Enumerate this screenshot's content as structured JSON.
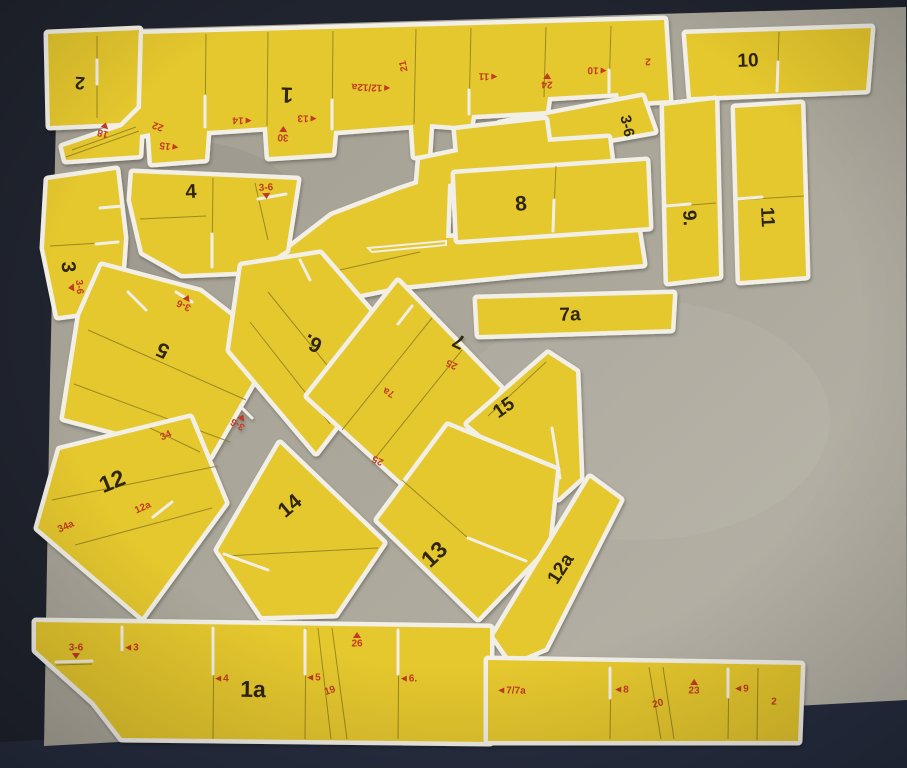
{
  "scene": {
    "description": "Photograph of a paper model kit: yellow cut-out card parts with white borders laid on a grey cardboard sheet on a dark table",
    "surface": "grey cardboard on dark navy table"
  },
  "colors": {
    "table_dark": "#20242e",
    "table_dark_bottom": "#272e40",
    "cardboard": "#a9a59a",
    "cardboard_light": "#b9b5aa",
    "paper_white": "#f2efe6",
    "part_yellow": "#e5c72f",
    "cut_line": "#8a7820",
    "number_black": "#2f2710",
    "mark_red": "#c03a20"
  },
  "parts": {
    "p1": {
      "number": "1"
    },
    "p1a": {
      "number": "1a"
    },
    "p2": {
      "number": "2"
    },
    "p3": {
      "number": "3"
    },
    "p4": {
      "number": "4"
    },
    "p5": {
      "number": "5"
    },
    "p6": {
      "number": "6."
    },
    "p7": {
      "number": "7"
    },
    "p7a": {
      "number": "7a"
    },
    "p8": {
      "number": "8"
    },
    "p9": {
      "number": "9."
    },
    "p10": {
      "number": "10"
    },
    "p11": {
      "number": "11"
    },
    "p12": {
      "number": "12"
    },
    "p12a": {
      "number": "12a"
    },
    "p13": {
      "number": "13"
    },
    "p14": {
      "number": "14"
    },
    "p15": {
      "number": "15"
    },
    "strip36": {
      "number": "3-6"
    }
  },
  "marks": {
    "p1_18": "18",
    "p1_22": "22",
    "p1_15": "◄15",
    "p1_14": "◄14",
    "p1_30": "30",
    "p1_13": "◄13",
    "p1_12_12a": "◄12/12a",
    "p1_21": "21",
    "p1_11": "◄11",
    "p1_24": "24",
    "p1_10": "◄10",
    "p1_2": "2",
    "p4_36": "3-6",
    "p3_36": "3-6",
    "p5_36": "3-6",
    "p6_36": "3-6",
    "p7_25a": "25",
    "p7_7a": "7a",
    "p7_25b": "25",
    "p12_34": "34",
    "p12_12a": "12a",
    "p12_34a": "34a",
    "p1a_36": "3-6",
    "p1a_3": "◄3",
    "p1a_4": "◄4",
    "p1a_5": "◄5",
    "p1a_19": "19",
    "p1a_26": "26",
    "p1a_6": "◄6.",
    "strip_77a": "◄7/7a",
    "strip_8": "◄8",
    "strip_20": "20",
    "strip_23": "23",
    "strip_9": "◄9",
    "strip_2": "2"
  }
}
